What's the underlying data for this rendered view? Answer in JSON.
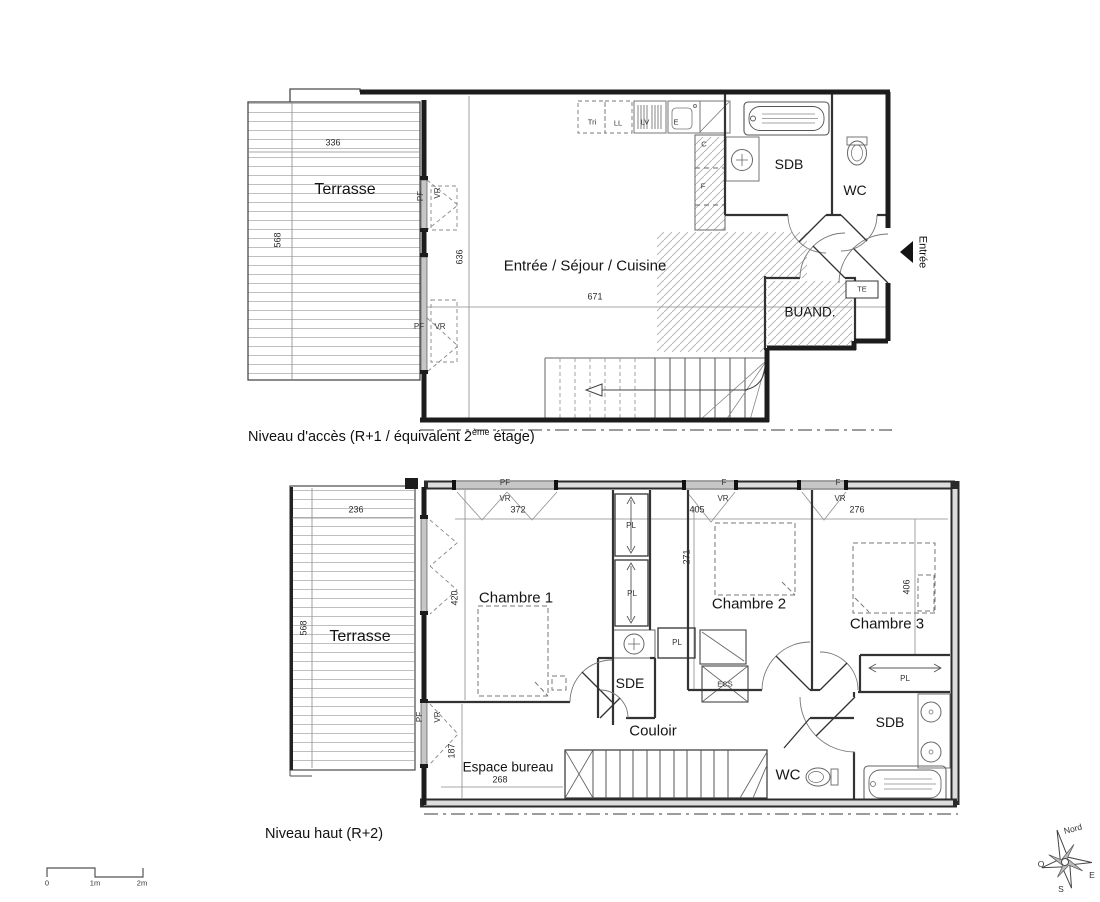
{
  "colors": {
    "background": "#ffffff",
    "walls": "#1c1c1c",
    "thin_lines": "#555555",
    "hatch": "#b5b5b5"
  },
  "upper_plan": {
    "caption_pre": "Niveau d'accès (R+1 / équivalent 2",
    "caption_sup": "ème",
    "caption_post": " étage)",
    "terrace": {
      "label": "Terrasse",
      "dim_width": "336",
      "dim_height": "568"
    },
    "living": {
      "label": "Entrée / Séjour / Cuisine",
      "dim_width": "671",
      "dim_height": "636"
    },
    "window_labels": {
      "pf": "PF",
      "vr": "VR"
    },
    "kitchen": {
      "tri": "Tri",
      "washer": "LL",
      "dishwasher": "LV",
      "sink": "E",
      "column_top": "C",
      "column_bottom": "F"
    },
    "bathroom": "SDB",
    "wc": "WC",
    "laundry": "BUAND.",
    "electrical": "TE",
    "entrance": "Entrée"
  },
  "lower_plan": {
    "caption": "Niveau haut (R+2)",
    "terrace": {
      "label": "Terrasse",
      "dim_width": "236",
      "dim_height": "568"
    },
    "bedroom1": {
      "label": "Chambre 1",
      "dim_width": "372",
      "dim_height": "420"
    },
    "bedroom2": {
      "label": "Chambre 2",
      "dim_width": "405",
      "dim_height": "271"
    },
    "bedroom3": {
      "label": "Chambre 3",
      "dim_width": "276",
      "dim_height": "406"
    },
    "office": {
      "label": "Espace bureau",
      "dim_width": "268",
      "dim_height": "187"
    },
    "corridor": "Couloir",
    "shower_room": "SDE",
    "bathroom": "SDB",
    "wc": "WC",
    "closet": "PL",
    "water_heater": "ECS",
    "window_labels": {
      "pf": "PF",
      "f": "F",
      "vr": "VR"
    }
  },
  "scale_bar": {
    "zero": "0",
    "one": "1m",
    "two": "2m"
  },
  "compass": {
    "north": "Nord",
    "west": "O",
    "east": "E",
    "south": "S"
  }
}
